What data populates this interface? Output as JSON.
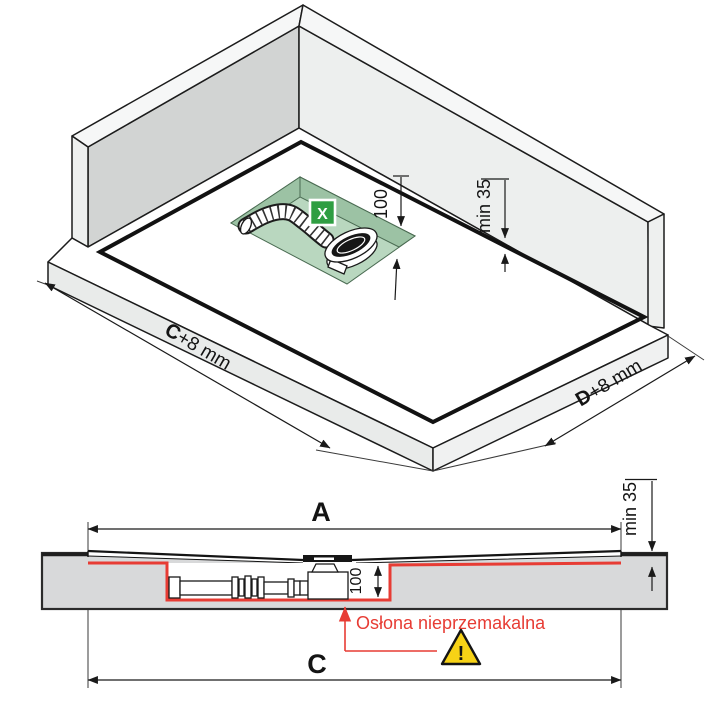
{
  "iso": {
    "dim_c_bold": "C",
    "dim_c_rest": "+8 mm",
    "dim_d_bold": "D",
    "dim_d_rest": "+8 mm",
    "depth_label": "100",
    "min_gap_label": "min 35",
    "x_badge": "X"
  },
  "section": {
    "dim_a": "A",
    "dim_c": "C",
    "depth_label": "100",
    "min_gap_label": "min 35",
    "waterproof_label": "Osłona nieprzemakalna",
    "warning_mark": "!"
  },
  "colors": {
    "accent_red": "#e73c34",
    "badge_green": "#2f9e42",
    "warning_yellow": "#f7d216",
    "recess_green": "#b9d7bf",
    "recess_green_dark": "#9cc2a4",
    "wall_gray": "#d2d4d3",
    "slab_gray": "#d8d9da"
  }
}
